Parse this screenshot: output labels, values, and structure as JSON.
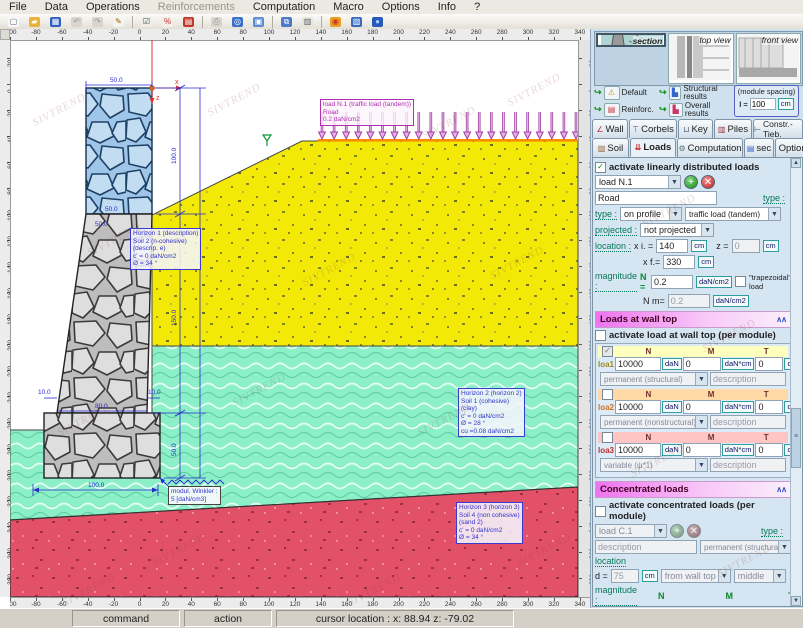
{
  "menu": {
    "items": [
      {
        "label": "File",
        "disabled": false
      },
      {
        "label": "Data",
        "disabled": false
      },
      {
        "label": "Operations",
        "disabled": false
      },
      {
        "label": "Reinforcements",
        "disabled": true
      },
      {
        "label": "Computation",
        "disabled": false
      },
      {
        "label": "Macro",
        "disabled": false
      },
      {
        "label": "Options",
        "disabled": false
      },
      {
        "label": "Info",
        "disabled": false
      },
      {
        "label": "?",
        "disabled": false
      }
    ]
  },
  "toolbar": {
    "groups": [
      [
        {
          "name": "new-file-icon",
          "glyph": "▢",
          "bg": "#f8f8f8",
          "fg": "#567"
        },
        {
          "name": "open-folder-icon",
          "glyph": "▰",
          "bg": "#e8b23c",
          "fg": "#fff"
        },
        {
          "name": "save-icon",
          "glyph": "▦",
          "bg": "#2f5fc0",
          "fg": "#fff"
        },
        {
          "name": "undo-icon",
          "glyph": "↶",
          "bg": "#d8d5cc",
          "fg": "#999"
        },
        {
          "name": "redo-icon",
          "glyph": "↷",
          "bg": "#d8d5cc",
          "fg": "#999"
        },
        {
          "name": "edit-icon",
          "glyph": "✎",
          "bg": "#f4f4f0",
          "fg": "#a50"
        }
      ],
      [
        {
          "name": "verify-icon",
          "glyph": "☑",
          "bg": "#f0ece0",
          "fg": "#357"
        },
        {
          "name": "percent-icon",
          "glyph": "%",
          "bg": "#f4f0e8",
          "fg": "#b33"
        },
        {
          "name": "book-icon",
          "glyph": "▤",
          "bg": "#c03828",
          "fg": "#fff"
        }
      ],
      [
        {
          "name": "preview-icon",
          "glyph": "⎙",
          "bg": "#d8d5cc",
          "fg": "#999"
        },
        {
          "name": "settings-icon",
          "glyph": "◎",
          "bg": "#3a70c8",
          "fg": "#fff"
        },
        {
          "name": "window-icon",
          "glyph": "▣",
          "bg": "#5a8ad0",
          "fg": "#fff"
        }
      ],
      [
        {
          "name": "cascade-windows-icon",
          "glyph": "⧉",
          "bg": "#4a7ac8",
          "fg": "#fff"
        },
        {
          "name": "export-icon",
          "glyph": "▥",
          "bg": "#e8e4d8",
          "fg": "#567"
        }
      ],
      [
        {
          "name": "colors-icon",
          "glyph": "◉",
          "bg": "#e8a020",
          "fg": "#c33"
        },
        {
          "name": "panel-icon",
          "glyph": "▧",
          "bg": "#3a6ac0",
          "fg": "#fff"
        },
        {
          "name": "globe-icon",
          "glyph": "●",
          "bg": "#2858b8",
          "fg": "#9cf"
        }
      ]
    ]
  },
  "canvas": {
    "rulers": {
      "h": {
        "start": -100,
        "step": 20,
        "count": 23,
        "px0": 0,
        "pxStep": 25.9
      },
      "v": {
        "start": 20,
        "step": -20,
        "count": 21,
        "px0": 18,
        "pxStep": 26
      }
    },
    "watermark_text": "SIVTREND",
    "watermarks": [
      [
        30,
        75
      ],
      [
        205,
        65
      ],
      [
        420,
        88
      ],
      [
        505,
        55
      ],
      [
        85,
        205
      ],
      [
        300,
        235
      ],
      [
        488,
        228
      ],
      [
        55,
        385
      ],
      [
        230,
        355
      ],
      [
        415,
        385
      ],
      [
        150,
        515
      ],
      [
        345,
        555
      ],
      [
        515,
        515
      ],
      [
        60,
        555
      ]
    ],
    "panel_watermarks": [
      [
        640,
        205
      ],
      [
        700,
        330
      ],
      [
        628,
        455
      ],
      [
        715,
        555
      ]
    ],
    "arrows": {
      "count": 22,
      "x0": 312,
      "x1": 566,
      "yTop": 72,
      "yTip": 99
    },
    "load_label": {
      "l1": "load N.1 (traffic load (tandem))",
      "l2": "Road",
      "l3": "0.2 daN/cm2"
    },
    "horizon1": {
      "l1": "Horizon 1 (description)",
      "l2": "Soil 2 (n-cohesive)",
      "l3": "(descrip. e)",
      "l4": "c' = 0 daN/cm2",
      "l5": "Ø = 34 °"
    },
    "horizon2": {
      "l1": "Horizon 2 (horizon 2)",
      "l2": "Soil 1 (cohesive)",
      "l3": "(clay)",
      "l4": "c' = 0 daN/cm2",
      "l5": "Ø = 28 °",
      "l6": "cu =0.08 daN/cm2"
    },
    "horizon3": {
      "l1": "Horizon 3 (horizon 3)",
      "l2": "Soil 4 (non cohesive)",
      "l3": "(sand 2)",
      "l4": "c' = 0 daN/cm2",
      "l5": "Ø = 34 °"
    },
    "winkler": {
      "l1": "modul. Winkler :",
      "l2": "5 [daN/cm3]"
    },
    "dims": {
      "wall_top_w": "50.0",
      "wall_upper_h": "100.0",
      "stem_top_w": "50.0",
      "stem_top_w2": "50.0",
      "stem_h": "150.0",
      "footing_h": "50.0",
      "heel": "10.0",
      "stem_base": "80.0",
      "toe": "10.0",
      "footing_w": "100.0"
    },
    "axis": {
      "x": "x",
      "z": "z"
    }
  },
  "panel": {
    "views": [
      {
        "label": "section"
      },
      {
        "label": "top view"
      },
      {
        "label": "front view"
      }
    ],
    "quick": {
      "default": "Default",
      "reinforc": "Reinforc.",
      "structural": "Structural results",
      "overall": "Overall results"
    },
    "module_spacing": {
      "label": "(module spacing)",
      "symbol": "l =",
      "value": "100",
      "unit": "cm"
    },
    "tabs1": [
      {
        "label": "Wall",
        "icon": "∠"
      },
      {
        "label": "Corbels",
        "icon": "⊤"
      },
      {
        "label": "Key",
        "icon": "⊔"
      },
      {
        "label": "Piles",
        "icon": "▥"
      },
      {
        "label": "Constr.-Tieb.",
        "icon": "⊢"
      }
    ],
    "tabs2": [
      {
        "label": "Soil",
        "icon": "▨"
      },
      {
        "label": "Loads",
        "icon": "⇊"
      },
      {
        "label": "Computation",
        "icon": "⚙"
      },
      {
        "label": "sec",
        "icon": "▤"
      },
      {
        "label": "Options",
        "icon": ""
      }
    ],
    "distributed": {
      "activate_label": "activate linearly distributed loads",
      "load_select": "load N.1",
      "name_value": "Road",
      "type_label": "type :",
      "type_value": "on profile",
      "type2_label": "type :",
      "type2_value": "traffic load (tandem)",
      "projected_label": "projected :",
      "projected_value": "not projected",
      "location_label": "location :",
      "xi_label": "x i. =",
      "xi": "140",
      "xi_unit": "cm",
      "z_label": "z =",
      "z": "0",
      "z_unit": "cm",
      "xf_label": "x f.=",
      "xf": "330",
      "xf_unit": "cm",
      "magnitude_label": "magnitude :",
      "n_label": "N =",
      "n": "0.2",
      "n_unit": "daN/cm2",
      "trapezoidal_label": "\"trapezoidal\" load",
      "nm_label": "N m=",
      "nm": "0.2",
      "nm_unit": "daN/cm2"
    },
    "wall_top": {
      "header": "Loads at wall top",
      "activate_label": "activate load at wall top (per module)",
      "col_n": "N",
      "col_m": "M",
      "col_t": "T",
      "rows": [
        {
          "id": "loa1",
          "n": "10000",
          "n_unit": "daN",
          "m": "0",
          "m_unit": "daN*cm",
          "t": "0",
          "t_unit": "daN",
          "category": "permanent (structural)",
          "description": "description"
        },
        {
          "id": "loa2",
          "n": "10000",
          "n_unit": "daN",
          "m": "0",
          "m_unit": "daN*cm",
          "t": "0",
          "t_unit": "daN",
          "category": "permanent (nonstructural)",
          "description": "description"
        },
        {
          "id": "loa3",
          "n": "10000",
          "n_unit": "daN",
          "m": "0",
          "m_unit": "daN*cm",
          "t": "0",
          "t_unit": "daN",
          "category": "variable (ψ*1)",
          "description": "description"
        }
      ]
    },
    "concentrated": {
      "header": "Concentrated loads",
      "activate_label": "activate concentrated loads (per module)",
      "load_select": "load C.1",
      "type_label": "type :",
      "description": "description",
      "category": "permanent (structural)",
      "location_label": "location",
      "d_label": "d =",
      "d": "75",
      "d_unit": "cm",
      "ref_value": "from wall top",
      "pos_value": "middle",
      "magnitude_label": "magnitude :",
      "col_n": "N",
      "col_m": "M",
      "col_t": "T",
      "n": "1000",
      "n_unit": "daN",
      "m": "5000",
      "m_unit": "daN*cm",
      "t": "200",
      "t_unit": "daN"
    },
    "options_header": "Options"
  },
  "statusbar": {
    "command": "command",
    "action": "action",
    "cursor": "cursor location :  x: 88.94  z: -79.02"
  }
}
